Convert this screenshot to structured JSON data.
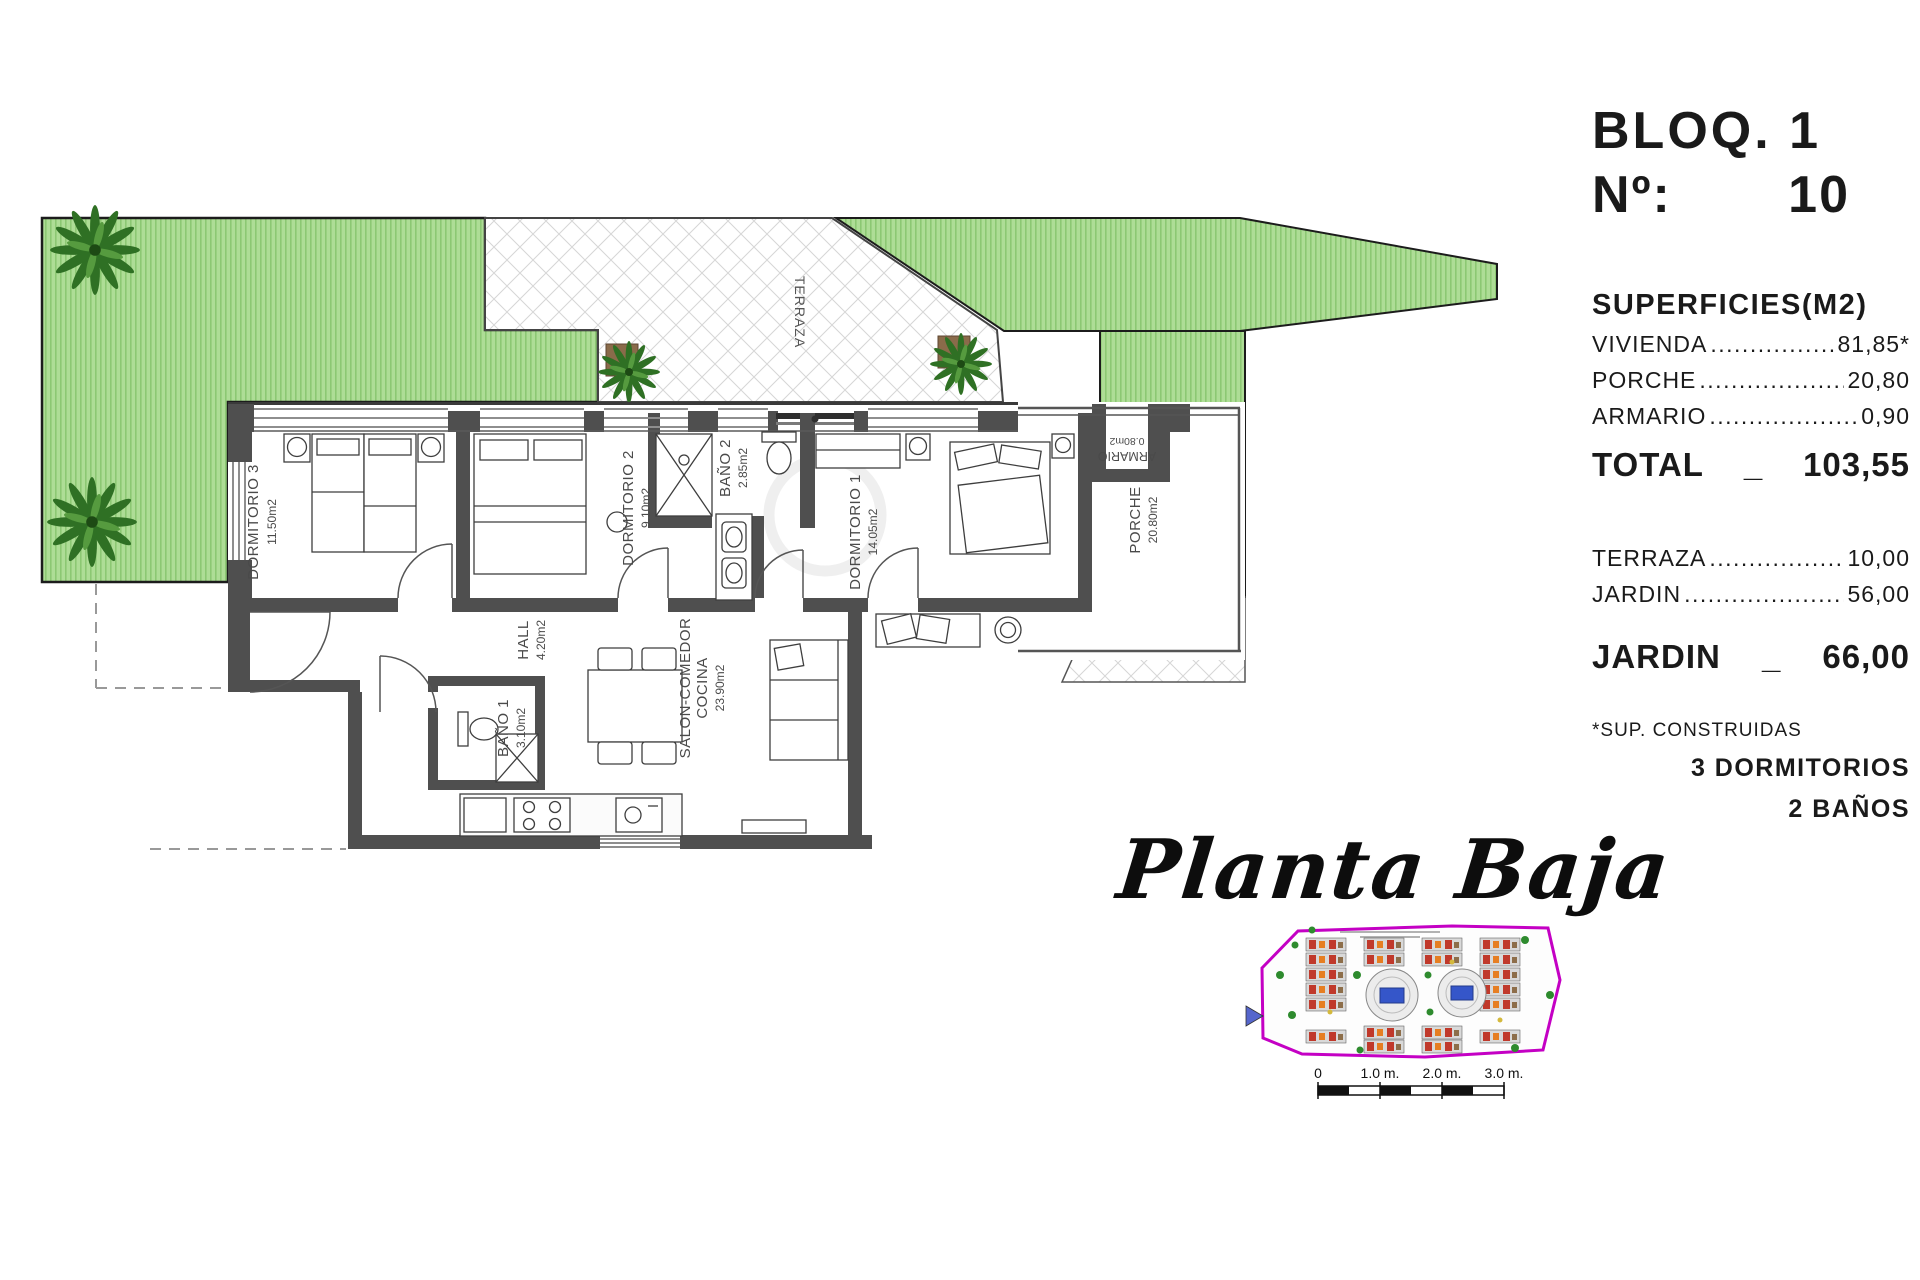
{
  "panel": {
    "bloq_line": "BLOQ. 1",
    "num_label": "Nº:",
    "num_value": "10",
    "superficies_title": "SUPERFICIES(M2)",
    "surface_rows": [
      {
        "label": "VIVIENDA",
        "value": "81,85*"
      },
      {
        "label": "PORCHE",
        "value": "20,80"
      },
      {
        "label": "ARMARIO",
        "value": "0,90"
      }
    ],
    "total_label": "TOTAL",
    "total_sep": "_",
    "total_value": "103,55",
    "outdoor_rows": [
      {
        "label": "TERRAZA",
        "value": "10,00"
      },
      {
        "label": "JARDIN",
        "value": "56,00"
      }
    ],
    "jardin_label": "JARDIN",
    "jardin_sep": "_",
    "jardin_value": "66,00",
    "footnote": "*SUP. CONSTRUIDAS",
    "bedrooms": "3 DORMITORIOS",
    "bathrooms": "2 BAÑOS",
    "leader_dots": "................................................................"
  },
  "plan": {
    "script_title": "Planta Baja",
    "rooms": [
      {
        "name": "DORMITORIO 3",
        "area": "11.50m2"
      },
      {
        "name": "DORMITORIO 2",
        "area": "9.10m2"
      },
      {
        "name": "BAÑO 2",
        "area": "2.85m2"
      },
      {
        "name": "DORMITORIO 1",
        "area": "14.05m2"
      },
      {
        "name": "HALL",
        "area": "4.20m2"
      },
      {
        "name": "BAÑO 1",
        "area": "3.10m2"
      },
      {
        "name": "SALON-COMEDOR",
        "name2": "COCINA",
        "area": "23.90m2"
      },
      {
        "name": "PORCHE",
        "area": "20.80m2"
      },
      {
        "name": "ARMARIO",
        "area": "0.80m2"
      },
      {
        "name": "TERRAZA",
        "area": ""
      }
    ]
  },
  "scalebar": {
    "labels": [
      "0",
      "1.0 m.",
      "2.0 m.",
      "3.0 m."
    ]
  },
  "colors": {
    "garden_green": "#aedd96",
    "garden_stripe": "#8cc873",
    "wall_gray": "#4f4f4f",
    "label_gray": "#4a4a4a",
    "minimap_border": "#c400c4",
    "pool_blue": "#3556c9"
  }
}
